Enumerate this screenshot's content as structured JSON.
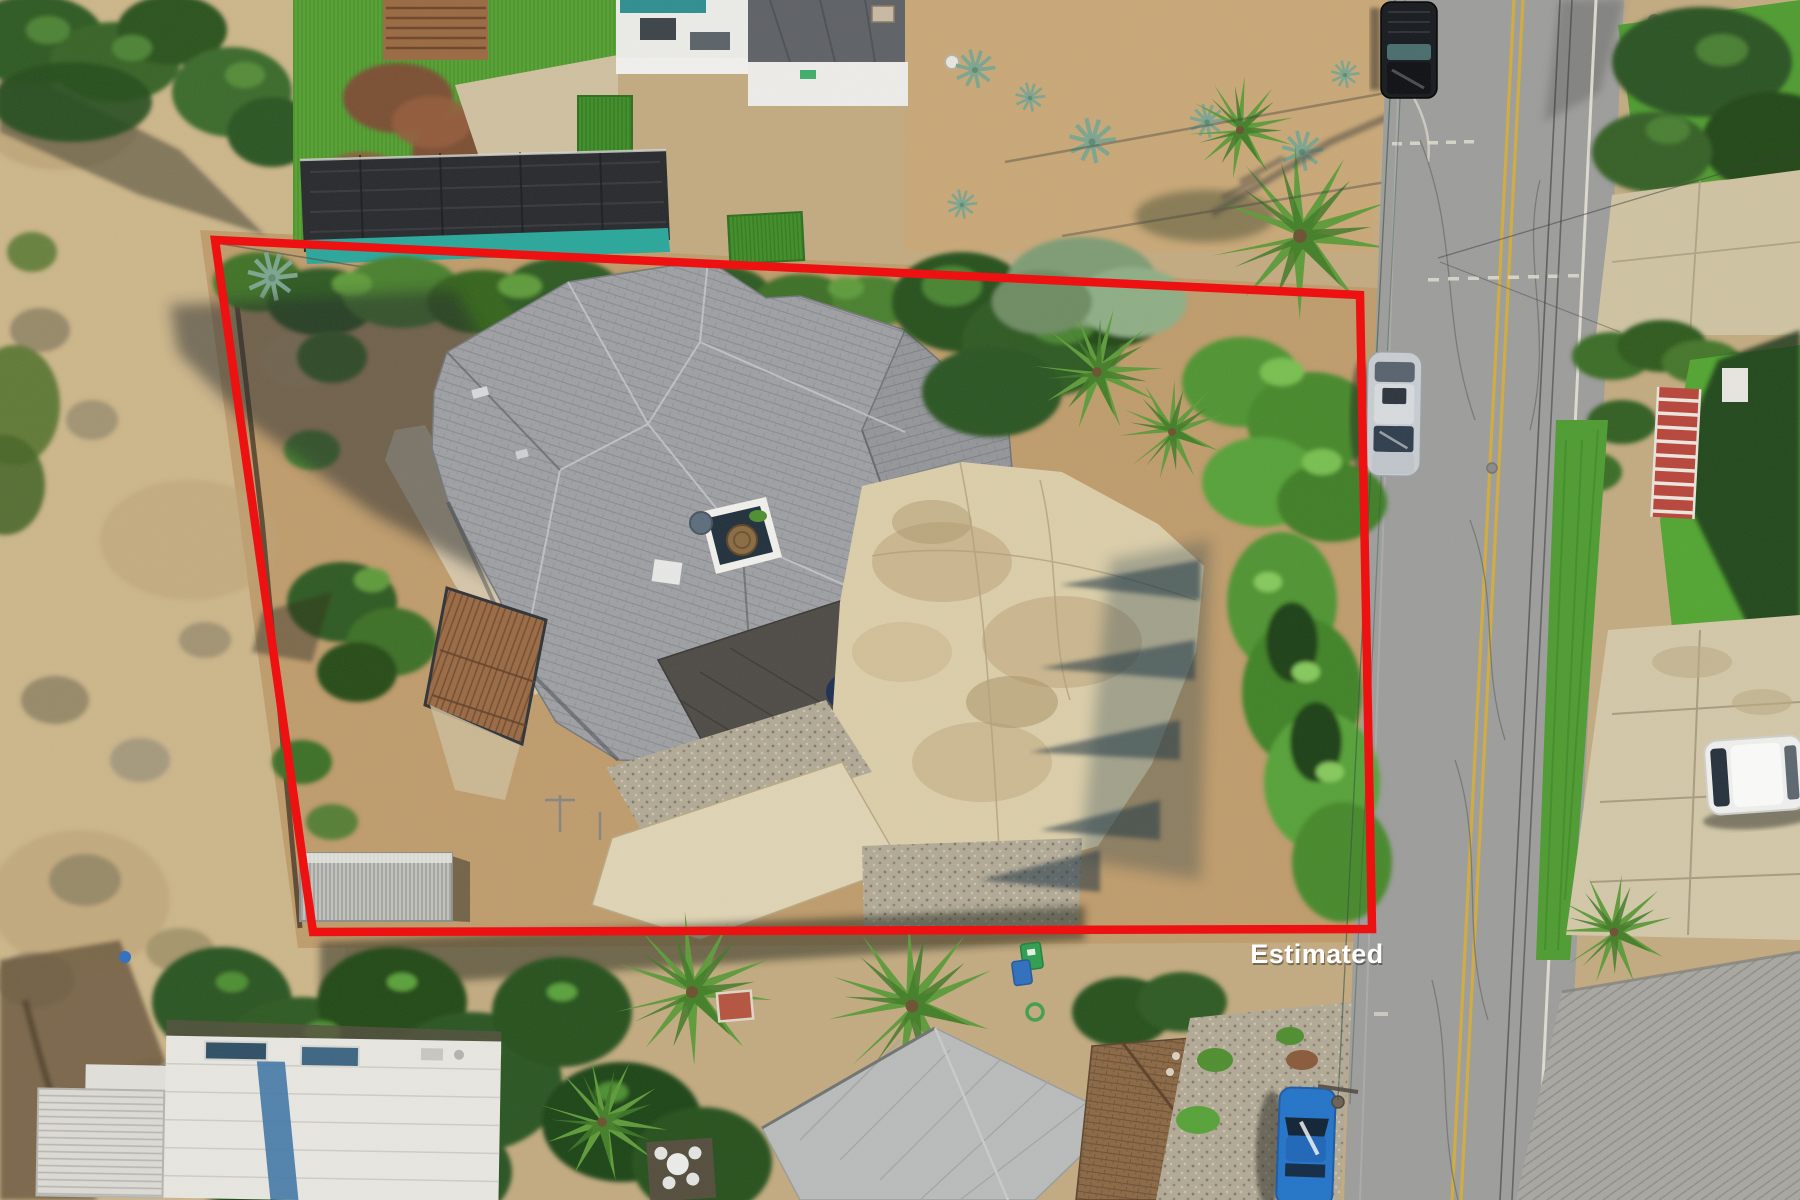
{
  "meta": {
    "description": "Aerial drone photo of a residential lot with red estimated-boundary overlay"
  },
  "overlay": {
    "label": "Estimated",
    "boundary": {
      "points": "215,240 1360,295 1372,929 313,932",
      "color": "#ee1111",
      "width": "8.5"
    }
  },
  "palette": {
    "dry_field": "#cdb68a",
    "lot_dirt": "#bf9c6c",
    "road_asphalt": "#9d9d9b",
    "road_yellow": "#d2ac3e",
    "road_white": "#e6e2d6",
    "roof_shingle": "#9ea0a3",
    "roof_dark_garage": "#4e4a46",
    "concrete_drive": "#dccea9",
    "lawn_green": "#55a233",
    "tree_dark": "#2c5520",
    "tree_bright": "#57a238",
    "shade_structure": "#27292c",
    "shade_teal": "#2aa79b",
    "car_black": "#16191d",
    "car_silver": "#c8cdd1",
    "car_white": "#f0f0ee",
    "car_blue": "#2374c9",
    "bin_green": "#2f9e4f",
    "bin_blue": "#2f6fbe"
  }
}
